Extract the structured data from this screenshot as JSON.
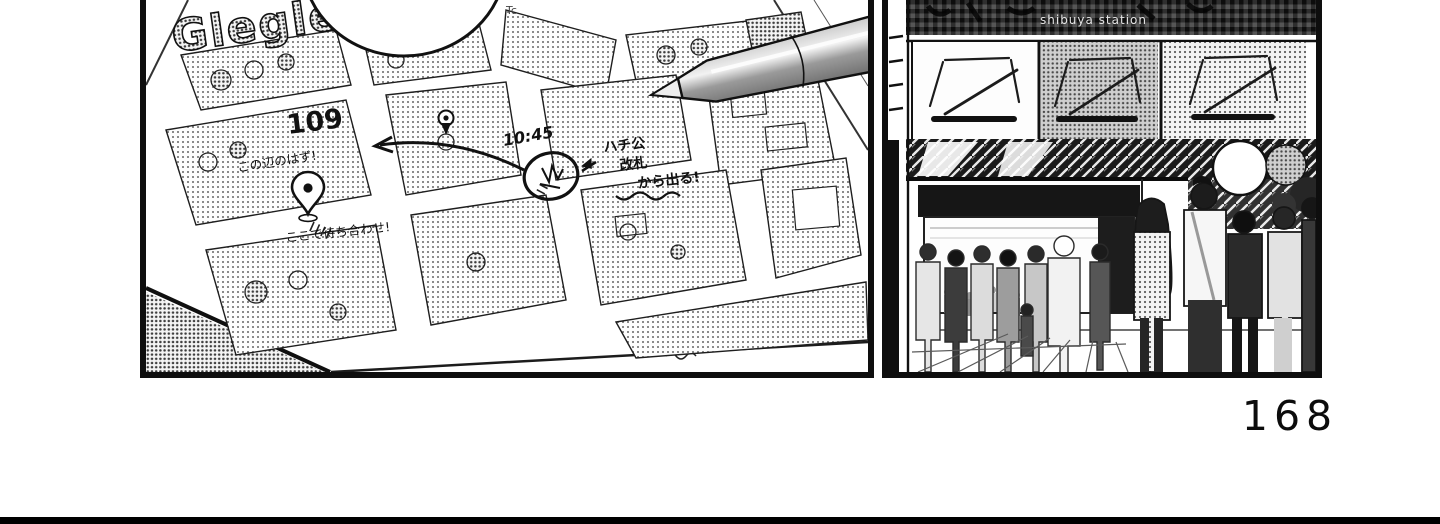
{
  "page": {
    "number": "168"
  },
  "panel_map": {
    "logo": "Glegle",
    "corner_label": "Tc",
    "building_label": "109",
    "meeting_time": "10:45",
    "exit_note": [
      "ハチ公",
      "改札",
      "から出る!"
    ],
    "route_note": "この辺のはず!",
    "pin_note": "ここで待ち合わせ!"
  },
  "panel_station": {
    "sign_text": "shibuya station"
  },
  "colors": {
    "ink": "#111111",
    "paper": "#ffffff",
    "halftone_dot": "#555555",
    "canopy": "#181818",
    "pen_body": "#8c8c8c",
    "window_gray": "#bdbdbd"
  }
}
